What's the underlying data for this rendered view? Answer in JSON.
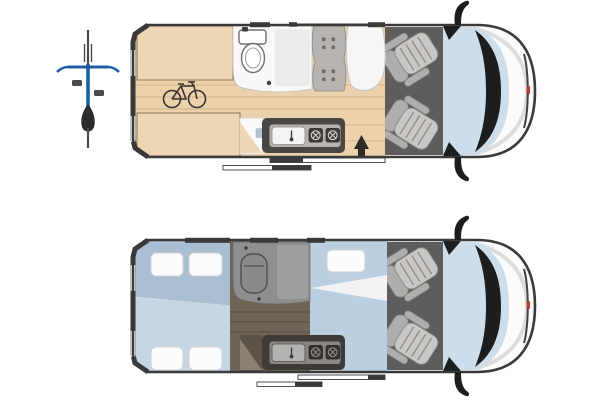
{
  "meta": {
    "description": "Camper van floorplan diagram with two top-view layouts (day configuration and night configuration) and a bicycle option marker",
    "views": 2,
    "visible_text": ""
  },
  "colors": {
    "outline": "#3a3a3a",
    "van_body": "#fbfbfb",
    "cab_floor": "#5e5d5c",
    "windshield": "#cdddea",
    "dash": "#1d1d1d",
    "brand_red": "#b23b35",
    "seat_light": "#c9c7c5",
    "seat_mid": "#b0aeac",
    "seat_line": "#8c8986",
    "wood": "#ebd2ad",
    "wood_stripe": "#dfc29b",
    "cabinet": "#eed6b4",
    "cabinet_border": "#8a7450",
    "bike_glyph": "#3a332b",
    "bath_white": "#f8f8f8",
    "shower_day": "#ebebeb",
    "bench": "#b7b4b1",
    "bench_dot": "#6f6b66",
    "table": "#f6f6f6",
    "counter": "#4b4642",
    "counter_panel": "#b5b2af",
    "hob": "#3f3b37",
    "arrow": "#2f2b27",
    "night_floor": "#6f6455",
    "night_stripe": "#63594b",
    "bed_upper": "#a9bed2",
    "bed_lower": "#c6d6e4",
    "bed_front": "#bccfe0",
    "pillow": "#fcfcfc",
    "bath_night": "#8f8f8f",
    "bike_blue": "#1d5fa6",
    "bike_gray": "#4b4b4b",
    "bike_saddle": "#2b2b2b"
  },
  "marker": {
    "icon": "bicycle-top-view-icon"
  },
  "day_layout": {
    "areas": [
      "rear-storage-cabinets",
      "bike-garage",
      "bathroom-toilet-shower",
      "dinette-bench",
      "dinette-table",
      "kitchen-sink-two-burners",
      "entry-arrow",
      "cab-two-seats"
    ],
    "bench_button_count": 8,
    "burner_count": 2
  },
  "night_layout": {
    "areas": [
      "rear-double-bed",
      "bathroom",
      "front-bed",
      "kitchen",
      "cab-two-seats"
    ],
    "rear_bed_pillows": 4,
    "front_bed_pillows": 1,
    "burner_count": 2
  }
}
